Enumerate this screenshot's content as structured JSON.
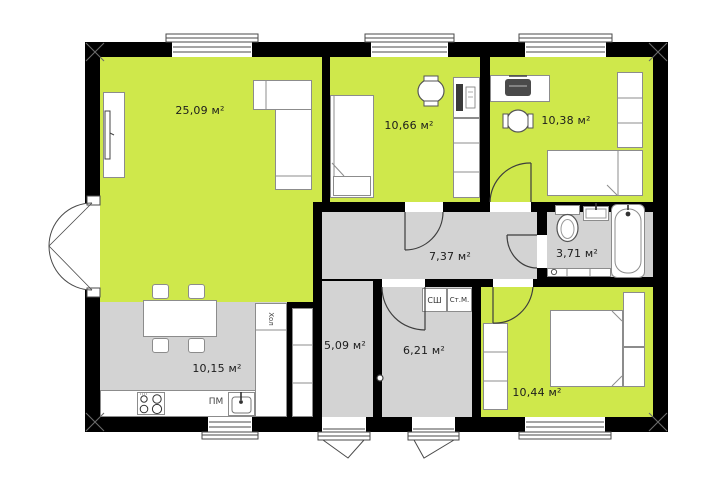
{
  "plan": {
    "name": "house-floor-plan",
    "colors": {
      "room_green": "#cfe84b",
      "service_gray": "#d3d3d3",
      "wall": "#000000"
    },
    "rooms": [
      {
        "key": "living-room",
        "area": "25,09 м²"
      },
      {
        "key": "bedroom-top-1",
        "area": "10,66 м²"
      },
      {
        "key": "bedroom-top-2",
        "area": "10,38 м²"
      },
      {
        "key": "hallway",
        "area": "7,37 м²"
      },
      {
        "key": "bathroom",
        "area": "3,71 м²"
      },
      {
        "key": "kitchen",
        "area": "10,15 м²"
      },
      {
        "key": "storage-room",
        "area": "5,09 м²"
      },
      {
        "key": "utility-room",
        "area": "6,21 м²"
      },
      {
        "key": "bedroom-bottom",
        "area": "10,44 м²"
      }
    ],
    "appliances": {
      "fridge": "Хол",
      "dishwasher": "ПМ",
      "dryer": "СШ",
      "washing_machine": "Ст.М."
    }
  }
}
